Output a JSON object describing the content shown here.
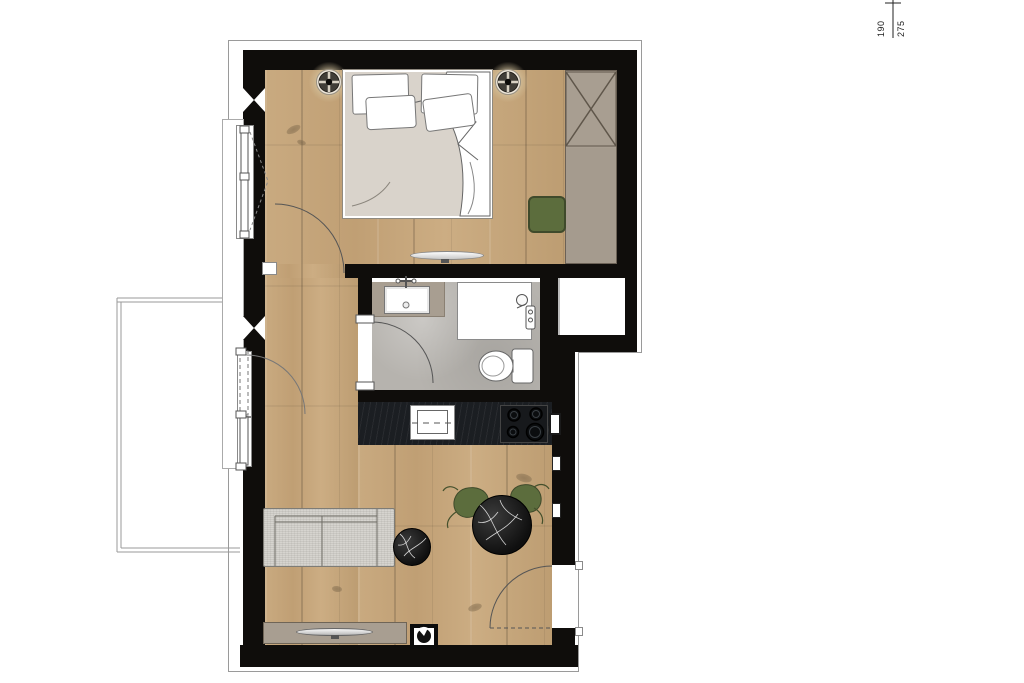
{
  "annotations": {
    "dim_a": "190",
    "dim_b": "275"
  },
  "colors": {
    "wall": "#0f0d0b",
    "wood": "#c7a87d",
    "tile": "#b6b3ae",
    "counter": "#1b1e22",
    "taupe": "#a89e91",
    "taupe_dark": "#6f6557",
    "green": "#5c6d3d",
    "green_dark": "#3f4a2b",
    "sofa": "#d6d4cf",
    "marble": "#161616",
    "line": "#555555",
    "outline": "#9a9a9a",
    "halo": "#d6c5a0",
    "mattress": "#d9d3cb",
    "paper": "#ffffff"
  },
  "symbols": {
    "ceiling_light": "recessed-spot-circle-with-cross",
    "wall_break": "hourglass-insulation-marker",
    "wardrobe": "rectangle-with-x",
    "door_swing": "quarter-circle-arc",
    "floor_outlet": "black-square-circle-wedge"
  }
}
